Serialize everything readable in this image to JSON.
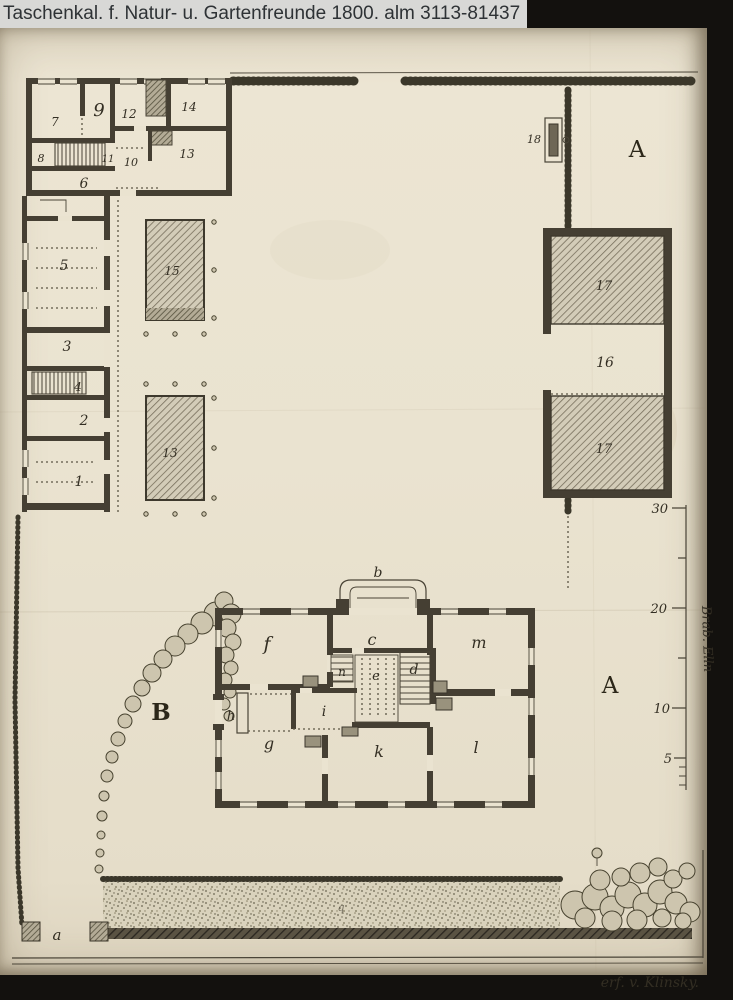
{
  "header": {
    "title": "Taschenkal. f. Natur- u. Gartenfreunde 1800. alm 3113-81437"
  },
  "plan": {
    "labels": {
      "t7": "7",
      "t9": "9",
      "t12": "12",
      "t14": "14",
      "t8": "8",
      "t11": "11",
      "t10": "10",
      "t13a": "13",
      "t6": "6",
      "t5": "5",
      "t3": "3",
      "t4": "4",
      "t2": "2",
      "t1": "1",
      "shed15": "15",
      "shed13": "13",
      "t18": "18",
      "a_top": "A",
      "t17a": "17",
      "t16": "16",
      "t17b": "17",
      "a_mid": "A",
      "b_big": "B",
      "gate_a": "a",
      "portico_b": "b",
      "f": "f",
      "c": "c",
      "m": "m",
      "n": "n",
      "e": "e",
      "d": "d",
      "h": "h",
      "i": "i",
      "g": "g",
      "k": "k",
      "l": "l",
      "ditch_q": "q"
    },
    "scale": {
      "t30": "30",
      "t20": "20",
      "t10": "10",
      "t5": "5",
      "caption": "Brab. Elln"
    },
    "signature": "erf. v. Klinsky.",
    "colors": {
      "paper": "#eae3d0",
      "ink": "#453f33",
      "titlebar_bg": "#d8d8d6"
    }
  }
}
